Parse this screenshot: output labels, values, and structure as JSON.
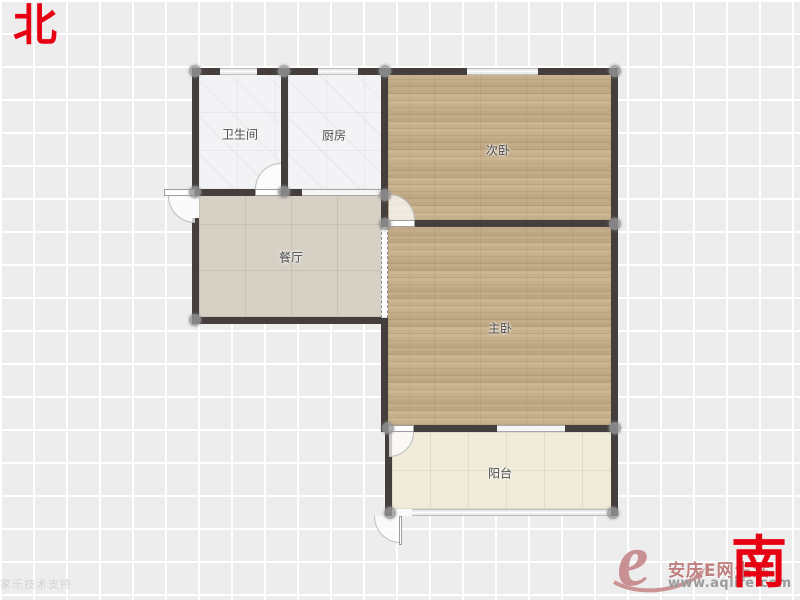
{
  "compass": {
    "north": "北",
    "south": "南"
  },
  "rooms": {
    "bathroom": {
      "label": "卫生间"
    },
    "kitchen": {
      "label": "厨房"
    },
    "secondary_bedroom": {
      "label": "次卧"
    },
    "dining": {
      "label": "餐厅"
    },
    "master_bedroom": {
      "label": "主卧"
    },
    "balcony": {
      "label": "阳台"
    }
  },
  "watermark": {
    "support": "酷家乐技术支持"
  },
  "logo": {
    "letter": "e",
    "title": "安庆E网生活",
    "url": "www.aqlife.com"
  },
  "colors": {
    "wall": "#443f3d",
    "compass_red": "#e60012",
    "wood_floor": "#c9b18b",
    "dining_tile": "#d7d0c5",
    "balcony_tile": "#f0ead9",
    "light_tile": "#f3f3f5",
    "logo_rose": "#bf7f7e",
    "grid_background": "#ededed"
  }
}
